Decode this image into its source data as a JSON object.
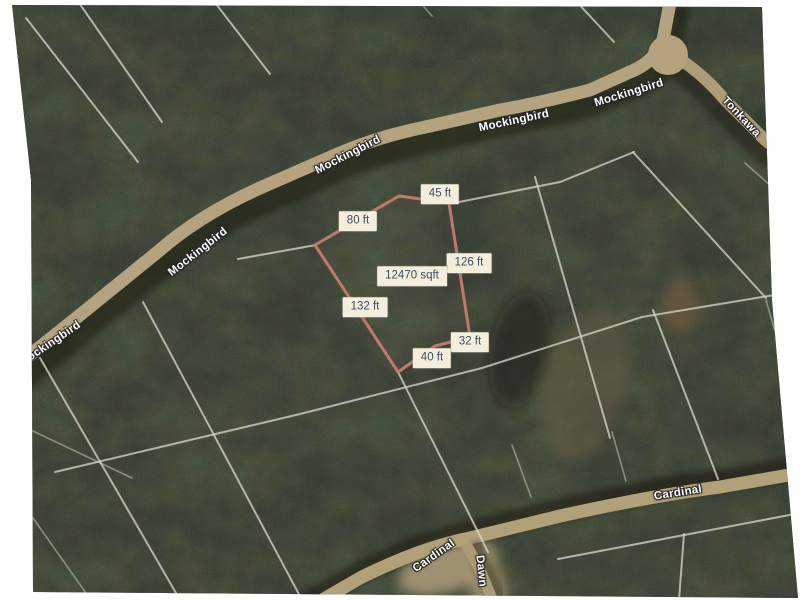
{
  "map": {
    "street_labels": [
      {
        "text": "Mockingbird",
        "x": 50,
        "y": 344,
        "rot": -34
      },
      {
        "text": "Mockingbird",
        "x": 198,
        "y": 252,
        "rot": -38
      },
      {
        "text": "Mockingbird",
        "x": 348,
        "y": 155,
        "rot": -27
      },
      {
        "text": "Mockingbird",
        "x": 514,
        "y": 121,
        "rot": -12
      },
      {
        "text": "Mockingbird",
        "x": 629,
        "y": 93,
        "rot": -17
      },
      {
        "text": "Tonkawa",
        "x": 741,
        "y": 117,
        "rot": 47
      },
      {
        "text": "Cardinal",
        "x": 678,
        "y": 493,
        "rot": -9
      },
      {
        "text": "Cardinal",
        "x": 434,
        "y": 556,
        "rot": -35
      },
      {
        "text": "Dawn",
        "x": 481,
        "y": 571,
        "rot": 84
      }
    ],
    "parcel": {
      "area_text": "12470 sqft",
      "vertices": [
        [
          315,
          245
        ],
        [
          399,
          196
        ],
        [
          449,
          203
        ],
        [
          470,
          337
        ],
        [
          435,
          346
        ],
        [
          398,
          372
        ]
      ],
      "measurements": [
        {
          "text": "45 ft",
          "x": 440,
          "y": 194
        },
        {
          "text": "80 ft",
          "x": 358,
          "y": 221
        },
        {
          "text": "126 ft",
          "x": 469,
          "y": 263
        },
        {
          "text": "12470 sqft",
          "x": 412,
          "y": 276
        },
        {
          "text": "132 ft",
          "x": 365,
          "y": 307
        },
        {
          "text": "32 ft",
          "x": 470,
          "y": 342
        },
        {
          "text": "40 ft",
          "x": 432,
          "y": 358
        }
      ]
    },
    "colors": {
      "parcel_outline": "#ca7e70",
      "label_bg": "#f4efdc",
      "label_text": "#3d4c63",
      "street_text": "#ffffff",
      "road_dirt": "#b4a37e",
      "forest_base": "#4a5444"
    }
  }
}
